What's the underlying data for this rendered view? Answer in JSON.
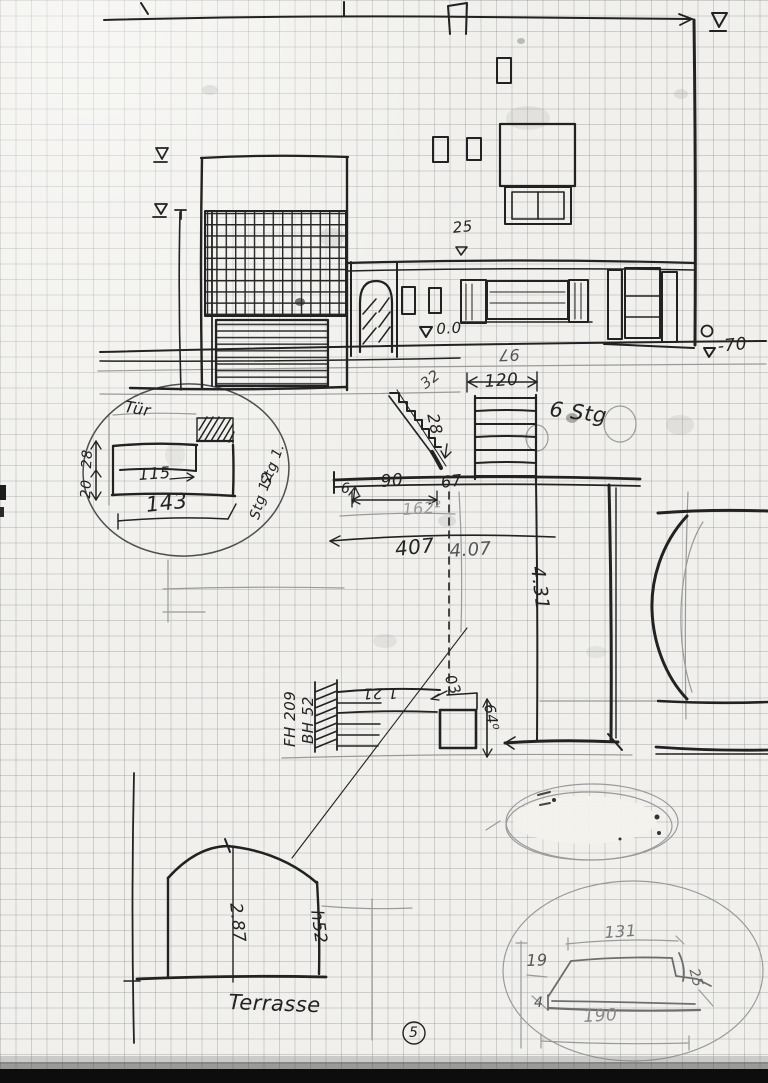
{
  "sketch": {
    "elevation": {
      "dim_25": "25",
      "level_zero": "0.0",
      "level_minus70": "-70",
      "dim_97": "97",
      "dim_32": "32"
    },
    "stairs": {
      "dim_120": "120",
      "dim_28": "28",
      "label_6stg": "6 Stg"
    },
    "plan": {
      "dim_6": "6",
      "dim_90": "90",
      "dim_67": "67",
      "dim_162": "162²",
      "dim_407": "407",
      "dim_4_07": "4.07",
      "dim_431": "4.31",
      "dim_121": "1.21",
      "dim_03": "03",
      "dim_64": "64⁰",
      "label_fh": "FH 209",
      "label_bh": "BH 52"
    },
    "detail": {
      "label_tuer": "Tür",
      "dim_115": "115",
      "dim_143": "143",
      "dim_28": "28",
      "dim_20": "20",
      "label_stg1": "Stg 1.",
      "label_stg12": "Stg 12"
    },
    "terrace": {
      "dim_287": "2.87",
      "dim_h52": "h52",
      "label": "Terrasse"
    },
    "bench": {
      "dim_131": "131",
      "dim_19": "19",
      "dim_4": "4",
      "dim_190": "190",
      "dim_25": "25"
    },
    "page_number": "5"
  },
  "colors": {
    "paper": "#f1f0ec",
    "grid": "#aeb6c2",
    "ink": "#222222",
    "pencil": "#9a9a9a"
  }
}
